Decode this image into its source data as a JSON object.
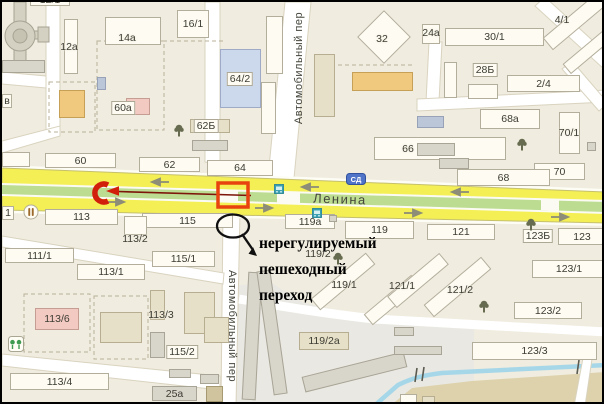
{
  "colors": {
    "background": "#f0ecdf",
    "road_yellow": "#f3ef55",
    "median_green": "#bcdc92",
    "highlight_red": "#e8430f",
    "route_red": "#d21f0c",
    "annotation_black": "#101010",
    "water_blue": "#a6d7e9"
  },
  "streets": {
    "main": "Ленина",
    "cross_top": "Автомобильный пер",
    "cross_bottom": "Автомобильный пер"
  },
  "annotation": {
    "lines": [
      "нерегулируемый",
      "пешеходный",
      "переход"
    ]
  },
  "map": {
    "buildings": [
      {
        "x": 28,
        "y": -9,
        "w": 40,
        "h": 13,
        "c": "w",
        "l": "12/1"
      },
      {
        "x": 0,
        "y": 58,
        "w": 43,
        "h": 13,
        "c": "g"
      },
      {
        "x": 62,
        "y": 17,
        "w": 14,
        "h": 55,
        "c": "w"
      },
      {
        "x": 103,
        "y": 15,
        "w": 56,
        "h": 28,
        "c": "w"
      },
      {
        "x": 175,
        "y": 8,
        "w": 32,
        "h": 28,
        "c": "w",
        "l": "16/1"
      },
      {
        "x": 57,
        "y": 88,
        "w": 26,
        "h": 28,
        "c": "o"
      },
      {
        "x": 95,
        "y": 75,
        "w": 9,
        "h": 13,
        "c": "b2"
      },
      {
        "x": 124,
        "y": 96,
        "w": 24,
        "h": 17,
        "c": "p"
      },
      {
        "x": 188,
        "y": 117,
        "w": 40,
        "h": 14,
        "c": "t"
      },
      {
        "x": 190,
        "y": 138,
        "w": 36,
        "h": 11,
        "c": "g"
      },
      {
        "x": 264,
        "y": 14,
        "w": 17,
        "h": 58,
        "c": "w"
      },
      {
        "x": 259,
        "y": 80,
        "w": 15,
        "h": 52,
        "c": "w"
      },
      {
        "x": 312,
        "y": 52,
        "w": 21,
        "h": 63,
        "c": "t"
      },
      {
        "x": 218,
        "y": 47,
        "w": 41,
        "h": 59,
        "c": "b"
      },
      {
        "x": 363,
        "y": 16,
        "w": 38,
        "h": 38,
        "c": "w",
        "rot": 45
      },
      {
        "x": 350,
        "y": 70,
        "w": 61,
        "h": 19,
        "c": "o"
      },
      {
        "x": 415,
        "y": 114,
        "w": 27,
        "h": 12,
        "c": "b2"
      },
      {
        "x": 372,
        "y": 135,
        "w": 132,
        "h": 23,
        "c": "w"
      },
      {
        "x": 415,
        "y": 141,
        "w": 38,
        "h": 13,
        "c": "g"
      },
      {
        "x": 437,
        "y": 156,
        "w": 30,
        "h": 11,
        "c": "g"
      },
      {
        "x": 420,
        "y": 22,
        "w": 18,
        "h": 20,
        "c": "w"
      },
      {
        "x": 443,
        "y": 26,
        "w": 99,
        "h": 18,
        "c": "w",
        "l": "30/1"
      },
      {
        "x": 537,
        "y": 10,
        "w": 75,
        "h": 16,
        "c": "w",
        "rot": -40
      },
      {
        "x": 558,
        "y": 42,
        "w": 58,
        "h": 13,
        "c": "w",
        "rot": -40
      },
      {
        "x": 442,
        "y": 60,
        "w": 13,
        "h": 36,
        "c": "w"
      },
      {
        "x": 466,
        "y": 82,
        "w": 30,
        "h": 15,
        "c": "w"
      },
      {
        "x": 505,
        "y": 73,
        "w": 73,
        "h": 17,
        "c": "w",
        "l": "2/4"
      },
      {
        "x": 478,
        "y": 107,
        "w": 60,
        "h": 20,
        "c": "w",
        "l": "68a"
      },
      {
        "x": 557,
        "y": 110,
        "w": 21,
        "h": 42,
        "c": "w"
      },
      {
        "x": 585,
        "y": 140,
        "w": 9,
        "h": 9,
        "c": "g"
      },
      {
        "x": 532,
        "y": 161,
        "w": 51,
        "h": 17,
        "c": "w",
        "l": "70"
      },
      {
        "x": 455,
        "y": 167,
        "w": 93,
        "h": 17,
        "c": "w",
        "l": "68"
      },
      {
        "x": 0,
        "y": 92,
        "w": 10,
        "h": 14,
        "c": "w",
        "l": "в"
      },
      {
        "x": 0,
        "y": 150,
        "w": 28,
        "h": 15,
        "c": "w"
      },
      {
        "x": 0,
        "y": 204,
        "w": 12,
        "h": 14,
        "c": "w",
        "l": "1"
      },
      {
        "x": 43,
        "y": 151,
        "w": 71,
        "h": 15,
        "c": "w",
        "l": "60"
      },
      {
        "x": 137,
        "y": 155,
        "w": 61,
        "h": 15,
        "c": "w",
        "l": "62"
      },
      {
        "x": 205,
        "y": 158,
        "w": 66,
        "h": 16,
        "c": "w",
        "l": "64"
      },
      {
        "x": 43,
        "y": 207,
        "w": 73,
        "h": 16,
        "c": "w",
        "l": "113"
      },
      {
        "x": 140,
        "y": 211,
        "w": 91,
        "h": 15,
        "c": "w",
        "l": "115"
      },
      {
        "x": 122,
        "y": 214,
        "w": 23,
        "h": 19,
        "c": "w"
      },
      {
        "x": 283,
        "y": 212,
        "w": 50,
        "h": 15,
        "c": "w",
        "l": "119a"
      },
      {
        "x": 327,
        "y": 213,
        "w": 8,
        "h": 7,
        "c": "g"
      },
      {
        "x": 343,
        "y": 219,
        "w": 69,
        "h": 18,
        "c": "w",
        "l": "119"
      },
      {
        "x": 425,
        "y": 222,
        "w": 68,
        "h": 16,
        "c": "w",
        "l": "121"
      },
      {
        "x": 556,
        "y": 226,
        "w": 48,
        "h": 17,
        "c": "w",
        "l": "123"
      },
      {
        "x": 3,
        "y": 246,
        "w": 69,
        "h": 15,
        "c": "w",
        "l": "111/1"
      },
      {
        "x": 150,
        "y": 249,
        "w": 63,
        "h": 16,
        "c": "w",
        "l": "115/1"
      },
      {
        "x": 75,
        "y": 262,
        "w": 68,
        "h": 16,
        "c": "w",
        "l": "113/1"
      },
      {
        "x": 33,
        "y": 306,
        "w": 44,
        "h": 22,
        "c": "p",
        "l": "113/6"
      },
      {
        "x": 98,
        "y": 310,
        "w": 42,
        "h": 31,
        "c": "t"
      },
      {
        "x": 148,
        "y": 288,
        "w": 15,
        "h": 30,
        "c": "t"
      },
      {
        "x": 148,
        "y": 330,
        "w": 15,
        "h": 26,
        "c": "g"
      },
      {
        "x": 182,
        "y": 290,
        "w": 31,
        "h": 42,
        "c": "t"
      },
      {
        "x": 167,
        "y": 367,
        "w": 22,
        "h": 9,
        "c": "g"
      },
      {
        "x": 8,
        "y": 371,
        "w": 99,
        "h": 17,
        "c": "w",
        "l": "113/4"
      },
      {
        "x": 198,
        "y": 372,
        "w": 19,
        "h": 10,
        "c": "g"
      },
      {
        "x": 204,
        "y": 384,
        "w": 17,
        "h": 16,
        "c": "ol"
      },
      {
        "x": 150,
        "y": 384,
        "w": 45,
        "h": 15,
        "c": "g",
        "l": "25a"
      },
      {
        "x": 202,
        "y": 315,
        "w": 25,
        "h": 26,
        "c": "t"
      },
      {
        "x": 243,
        "y": 270,
        "w": 14,
        "h": 128,
        "c": "g",
        "rot": 3
      },
      {
        "x": 263,
        "y": 268,
        "w": 14,
        "h": 125,
        "c": "g",
        "rot": -8
      },
      {
        "x": 297,
        "y": 330,
        "w": 50,
        "h": 18,
        "c": "t",
        "l": "119/2a"
      },
      {
        "x": 300,
        "y": 362,
        "w": 105,
        "h": 16,
        "c": "g",
        "rot": -14
      },
      {
        "x": 305,
        "y": 272,
        "w": 72,
        "h": 15,
        "c": "w",
        "rot": -40
      },
      {
        "x": 359,
        "y": 291,
        "w": 62,
        "h": 14,
        "c": "w",
        "rot": -40
      },
      {
        "x": 382,
        "y": 271,
        "w": 68,
        "h": 15,
        "c": "w",
        "rot": -40
      },
      {
        "x": 418,
        "y": 277,
        "w": 75,
        "h": 16,
        "c": "w",
        "rot": -40
      },
      {
        "x": 530,
        "y": 258,
        "w": 74,
        "h": 18,
        "c": "w",
        "l": "123/1"
      },
      {
        "x": 512,
        "y": 300,
        "w": 68,
        "h": 17,
        "c": "w",
        "l": "123/2"
      },
      {
        "x": 470,
        "y": 340,
        "w": 125,
        "h": 18,
        "c": "w",
        "l": "123/3"
      },
      {
        "x": 392,
        "y": 325,
        "w": 20,
        "h": 9,
        "c": "g"
      },
      {
        "x": 392,
        "y": 344,
        "w": 48,
        "h": 9,
        "c": "g"
      },
      {
        "x": 398,
        "y": 392,
        "w": 17,
        "h": 9,
        "c": "w"
      },
      {
        "x": 420,
        "y": 394,
        "w": 13,
        "h": 8,
        "c": "t"
      }
    ],
    "labels": [
      {
        "x": 67,
        "y": 45,
        "t": "12a"
      },
      {
        "x": 125,
        "y": 36,
        "t": "14a"
      },
      {
        "x": 380,
        "y": 37,
        "t": "32"
      },
      {
        "x": 406,
        "y": 147,
        "t": "66"
      },
      {
        "x": 560,
        "y": 18,
        "t": "4/1"
      },
      {
        "x": 429,
        "y": 31,
        "t": "24a"
      },
      {
        "x": 567,
        "y": 131,
        "t": "70/1"
      },
      {
        "x": 121,
        "y": 106,
        "t": "60a",
        "box": true
      },
      {
        "x": 204,
        "y": 124,
        "t": "62Б",
        "box": true
      },
      {
        "x": 238,
        "y": 77,
        "t": "64/2",
        "box": true
      },
      {
        "x": 483,
        "y": 68,
        "t": "28Б",
        "box": true
      },
      {
        "x": 133,
        "y": 237,
        "t": "113/2"
      },
      {
        "x": 536,
        "y": 234,
        "t": "123Б",
        "box": true
      },
      {
        "x": 159,
        "y": 313,
        "t": "113/3"
      },
      {
        "x": 180,
        "y": 350,
        "t": "115/2",
        "box": true
      },
      {
        "x": 316,
        "y": 252,
        "t": "119/2"
      },
      {
        "x": 342,
        "y": 283,
        "t": "119/1"
      },
      {
        "x": 400,
        "y": 284,
        "t": "121/1"
      },
      {
        "x": 458,
        "y": 288,
        "t": "121/2"
      },
      {
        "x": 563,
        "y": 267,
        "t": "123/1-dup-skip"
      }
    ],
    "icons": [
      {
        "t": "tree",
        "x": 177,
        "y": 128
      },
      {
        "t": "tree",
        "x": 520,
        "y": 142
      },
      {
        "t": "tree",
        "x": 529,
        "y": 222
      },
      {
        "t": "tree",
        "x": 336,
        "y": 256
      },
      {
        "t": "tree",
        "x": 482,
        "y": 304
      },
      {
        "t": "rest",
        "x": 29,
        "y": 210
      },
      {
        "t": "bus",
        "x": 277,
        "y": 187
      },
      {
        "t": "bus",
        "x": 315,
        "y": 211
      },
      {
        "t": "badge",
        "x": 354,
        "y": 177,
        "text": "СД"
      },
      {
        "t": "kids",
        "x": 14,
        "y": 342
      }
    ]
  }
}
